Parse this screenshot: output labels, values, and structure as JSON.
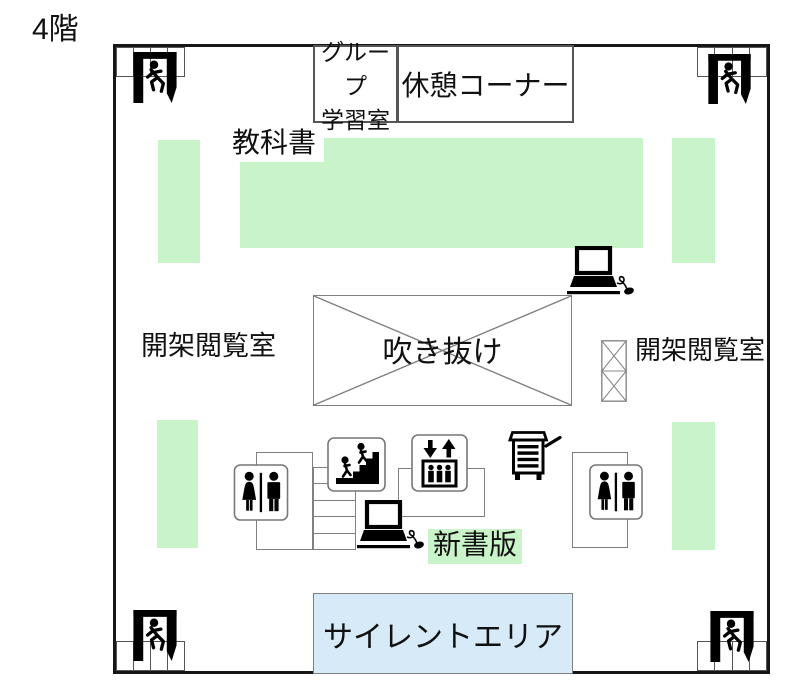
{
  "floor_title": "4階",
  "rooms": {
    "group_study_line1": "グループ",
    "group_study_line2": "学習室",
    "rest_corner": "休憩コーナー",
    "textbook": "教科書",
    "reading_room": "開架閲覧室",
    "atrium": "吹き抜け",
    "paperback": "新書版",
    "silent_area": "サイレントエリア"
  },
  "legend_colors": {
    "bookshelf_green": "#c9f3c9",
    "silent_area_blue": "#d6eaf8",
    "outline_gray": "#808080",
    "wall_black": "#161616"
  },
  "icons": {
    "exit": "emergency-exit-running-person",
    "toilet": "restroom-woman-man",
    "stairs": "people-climbing-stairs",
    "elevator": "elevator-arrows-passengers",
    "laptop": "laptop-with-mouse",
    "book_cart": "book-cart-with-drawers",
    "atrium_cross": "x-cross-void-mark",
    "shaft": "hatched-elevator-shaft"
  }
}
